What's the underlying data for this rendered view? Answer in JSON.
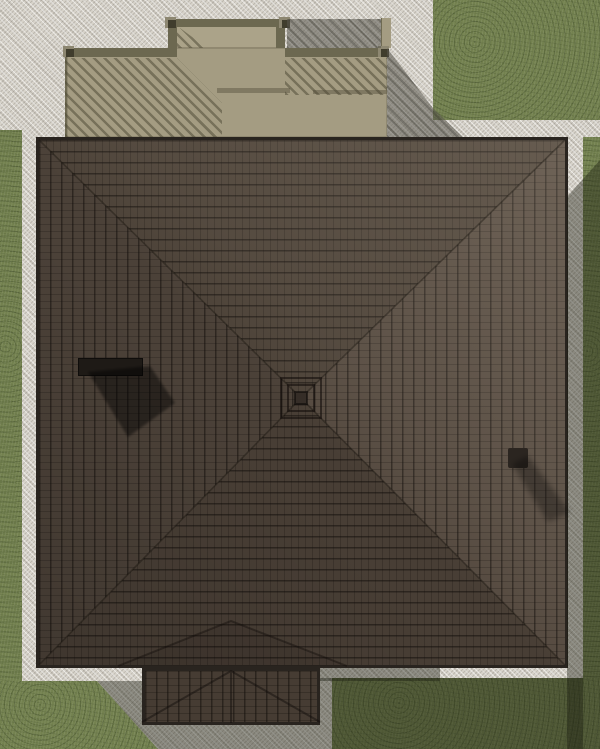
{
  "scene": {
    "title": "Top-down architectural rendering of a house hip roof",
    "view": "orthographic plan (bird's-eye) 3D render",
    "canvas": {
      "width_px": 600,
      "height_px": 749
    },
    "sun_shadow_direction": "south-east",
    "lawn": {
      "label": "grass lawn",
      "color_lit": "#73814f",
      "color_in_shadow": "#47532f",
      "areas": [
        "left-strip",
        "top-right-field",
        "right-strip",
        "bottom-left-corner",
        "bottom-right-field"
      ]
    },
    "walkway": {
      "label": "stone paver apron surrounding house",
      "color_lit": "#d7d3ca",
      "color_in_shadow": "#97958e"
    },
    "main_roof": {
      "label": "hip roof with concentric tile courses",
      "x": 36,
      "y": 137,
      "width": 532,
      "height": 531,
      "peak": {
        "x": 301,
        "y": 398
      },
      "tile_color": "#4c4138",
      "course_line_color": "#17120e",
      "eave_edge_color": "#29241f",
      "facet_colors": {
        "north": "#4c4238",
        "east": "#554a40",
        "south": "#483e35",
        "west": "#4b4138"
      },
      "highlight": "light wedge across north-east half",
      "chimney": {
        "x": 78,
        "y": 358,
        "width": 65,
        "height": 18,
        "color": "#1e1a16",
        "shadow": "diamond cast to south-east"
      },
      "vent": {
        "x": 508,
        "y": 448,
        "width": 20,
        "height": 20,
        "color": "#2b2520",
        "shadow": "streak cast to south-east"
      }
    },
    "porch_roof": {
      "label": "small entry porch roof at bottom",
      "x": 142,
      "y": 668,
      "width": 178,
      "height": 57,
      "ridge_x": 231,
      "tile_color": "#463c33",
      "valleys": "chevron valleys rising into main roof toward (231,621)"
    },
    "deck": {
      "label": "rear deck with railings at top of plan",
      "floor_color": "#a49c82",
      "upper_landing_color": "#aba389",
      "railing_color": "#6c6850",
      "post_color": "#403d2d",
      "post_cap_color": "#8d8771",
      "baluster_shadow_hatch_color": "#4a4632",
      "main_section": {
        "x": 65,
        "y": 48,
        "width": 322,
        "height": 89
      },
      "upper_landing": {
        "x": 168,
        "y": 19,
        "width": 117,
        "height": 29
      },
      "posts": [
        [
          63,
          46
        ],
        [
          165,
          17
        ],
        [
          279,
          17
        ],
        [
          378,
          46
        ]
      ]
    },
    "shadows": {
      "overlay_color": "#191c0e",
      "overlay_opacity": 0.4,
      "regions": [
        "right of house on pavers and grass",
        "below house on walkway and grass",
        "deck shadow on pavers",
        "chimney diamond",
        "vent streak"
      ]
    }
  }
}
